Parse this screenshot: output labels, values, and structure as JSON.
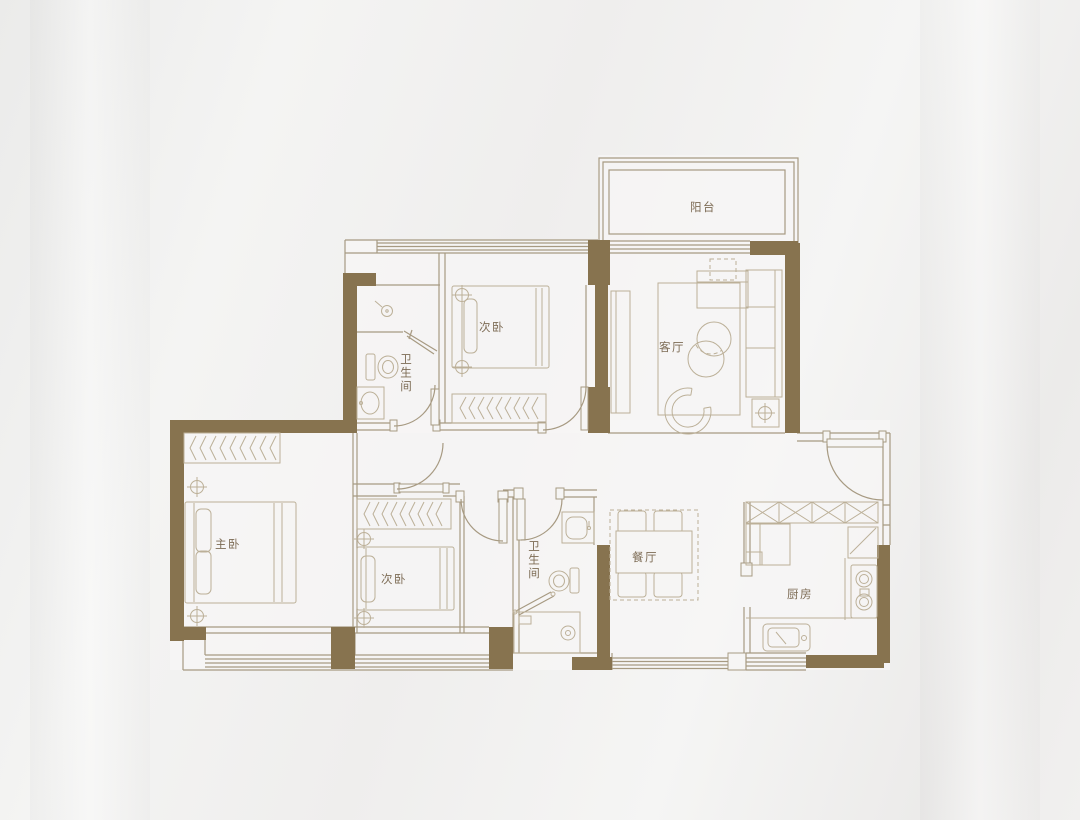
{
  "title": "apartment-floor-plan",
  "palette": {
    "wall_fill": "#87734f",
    "wall_line": "#a79a82",
    "furniture_line": "#bcb098",
    "label_text": "#7d6c55",
    "background": "#f0efee"
  },
  "rooms": {
    "balcony": {
      "label": "阳台"
    },
    "living": {
      "label": "客厅"
    },
    "bedroom_top": {
      "label": "次卧"
    },
    "bath_top": {
      "label": "卫生间"
    },
    "master": {
      "label": "主卧"
    },
    "bedroom_bottom": {
      "label": "次卧"
    },
    "bath_bottom": {
      "label": "卫生间"
    },
    "dining": {
      "label": "餐厅"
    },
    "kitchen": {
      "label": "厨房"
    }
  }
}
